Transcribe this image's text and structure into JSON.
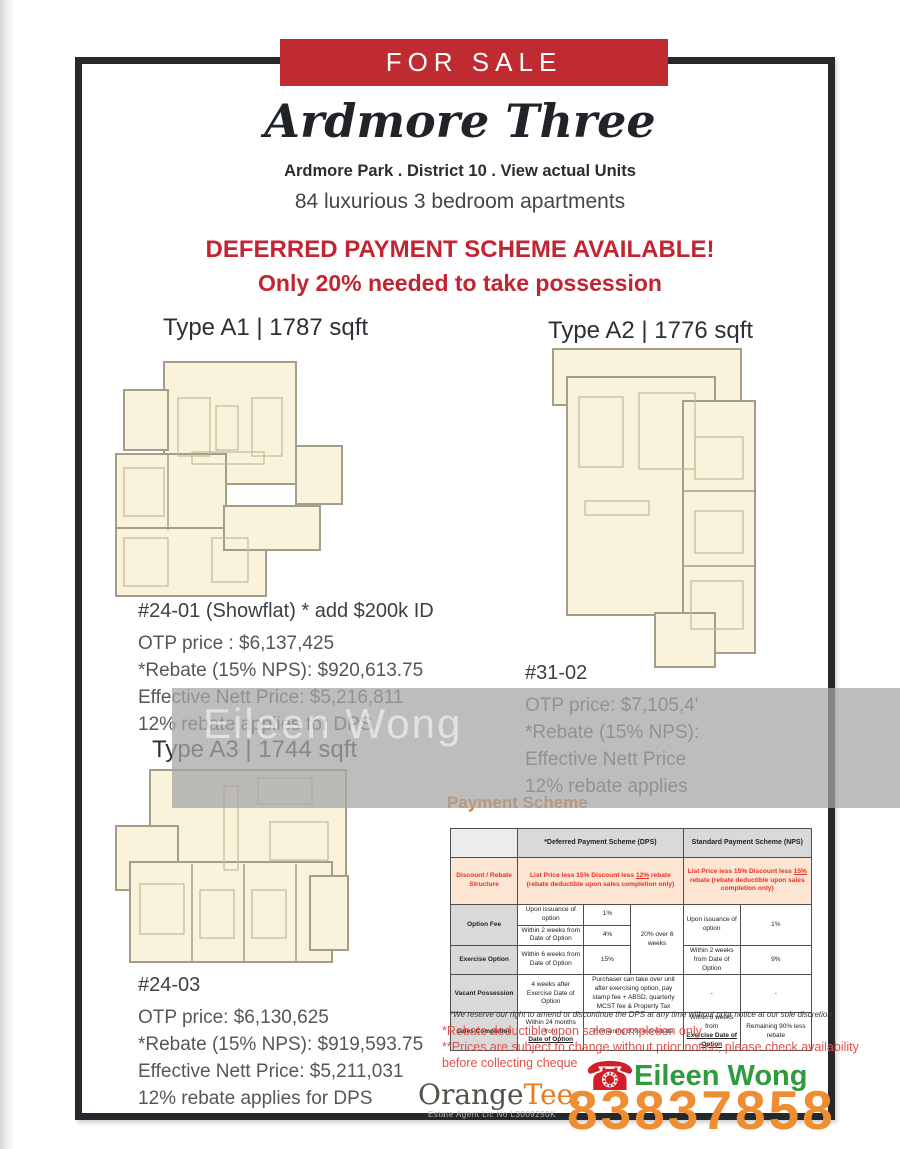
{
  "banner": {
    "label": "FOR SALE"
  },
  "header": {
    "title": "Ardmore Three",
    "subtitle": "Ardmore Park . District 10 . View actual Units",
    "tagline": "84 luxurious 3 bedroom apartments",
    "promo_line1": "DEFERRED PAYMENT SCHEME AVAILABLE!",
    "promo_line2": "Only 20% needed to take possession"
  },
  "units": {
    "a1": {
      "type_label": "Type A1 | 1787 sqft",
      "unit_no": "#24-01 (Showflat) * add $200k ID",
      "otp": "OTP price :  $6,137,425",
      "rebate": "*Rebate (15% NPS): $920,613.75",
      "nett": "Effective Nett Price: $5,216,811",
      "dps": "12% rebate applies for DPS"
    },
    "a2": {
      "type_label": "Type A2 | 1776 sqft",
      "unit_no": "#31-02",
      "otp": "OTP price:  $7,105,4'",
      "rebate": "*Rebate (15% NPS):",
      "nett": "Effective Nett Price",
      "dps": "12% rebate applies"
    },
    "a3": {
      "type_label": "Type A3 | 1744 sqft",
      "unit_no": "#24-03",
      "otp": "OTP price:  $6,130,625",
      "rebate": "*Rebate (15% NPS): $919,593.75",
      "nett": "Effective Nett Price: $5,211,031",
      "dps": "12% rebate applies for DPS"
    }
  },
  "watermark": {
    "text": "Eileen Wong"
  },
  "payment": {
    "heading": "Payment Scheme",
    "table": {
      "col_dps": "*Deferred Payment Scheme (DPS)",
      "col_nps": "Standard Payment Scheme (NPS)",
      "discount_label": "Discount / Rebate Structure",
      "discount_dps": {
        "pre": "List Price less 15% Discount less ",
        "pct": "12%",
        "post": " rebate (rebate deductible upon sales completion only)"
      },
      "discount_nps": {
        "pre": "List Price less 15% Discount less ",
        "pct": "15%",
        "post": " rebate (rebate deductible upon sales completion only)"
      },
      "rows": {
        "option_fee": {
          "label": "Option Fee",
          "dps1_desc": "Upon issuance of option",
          "dps1_pct": "1%",
          "dps2_desc": "Within 2 weeks from Date of Option",
          "dps2_pct": "4%",
          "dps_total": "20% over 6 weeks",
          "nps_desc": "Upon issuance of option",
          "nps_pct": "1%"
        },
        "exercise": {
          "label": "Exercise Option",
          "dps_desc": "Within 6 weeks from Date of Option",
          "dps_pct": "15%",
          "nps_desc": "Within 2 weeks from Date of Option",
          "nps_pct": "9%"
        },
        "vacant": {
          "label": "Vacant Possession",
          "dps_desc": "4 weeks after Exercise Date of Option",
          "dps_note": "Purchaser can take over unit after exercising option, pay stamp fee + ABSD, quarterly MCST fee & Property Tax",
          "nps_desc": "-",
          "nps_pct": "-"
        },
        "completion": {
          "label": "Sales Completion",
          "dps_desc_pre": "Within 24 months from",
          "dps_desc_u": "Date of Option",
          "dps_note": "Remaining 80% less rebate",
          "nps_desc_pre": "Within 6 weeks from",
          "nps_desc_u": "Exercise Date of Option",
          "nps_note": "Remaining 90% less rebate"
        }
      },
      "footnote": "*We reserve our right to amend or discontinue the DPS at any time without prior notice at our sole discretion"
    },
    "notes": [
      "*Rebate deductible upon sales completion only",
      "**Prices are subject to change without prior notice, please check availability before collecting cheque"
    ]
  },
  "footer": {
    "brand_part1": "Orange",
    "brand_part2": "Tee.",
    "license": "Estate Agent Lic No L3009250K",
    "phone_icon": "red-telephone",
    "agent_name": "Eileen Wong",
    "phone": "83837858"
  },
  "colors": {
    "banner_red": "#bf2b31",
    "promo_red": "#c32431",
    "table_red": "#e93120",
    "orange_heading": "#e2761c",
    "brand_orange": "#e87b20",
    "agent_green": "#2e9b3c",
    "phone_orange": "#ef8d33",
    "floorplan_cream": "#f8f3da",
    "floorplan_wall": "#a59c8a",
    "watermark_gray": "#a6a6a6"
  }
}
